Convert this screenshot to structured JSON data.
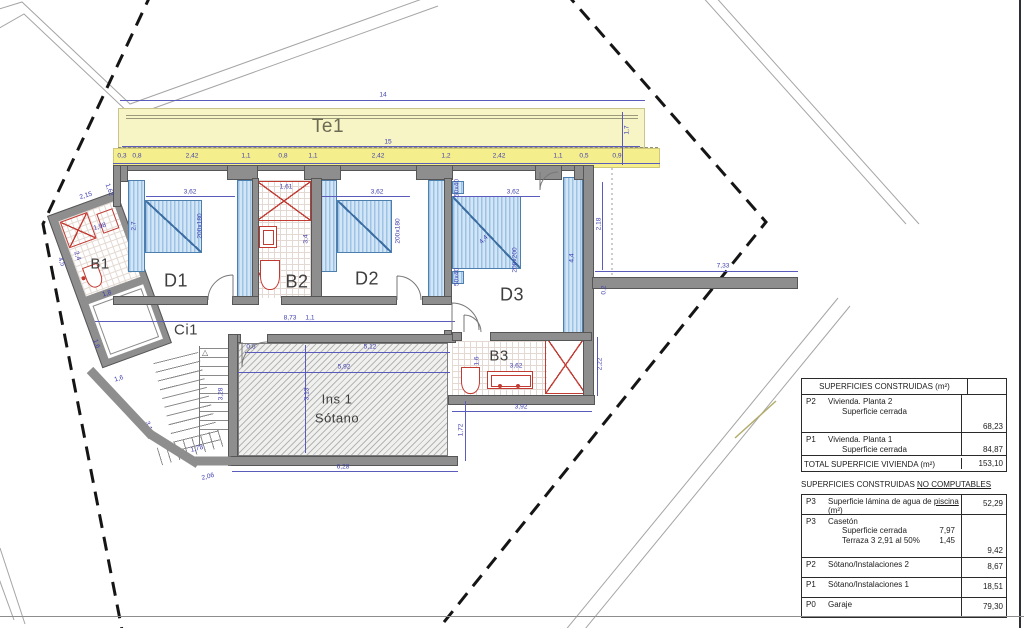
{
  "drawing": {
    "rooms": {
      "terrace": "Te1",
      "b1": "B1",
      "d1": "D1",
      "b2": "B2",
      "d2": "D2",
      "d3": "D3",
      "b3": "B3",
      "ci1": "Ci1",
      "ins_line1": "Ins 1",
      "ins_line2": "Sótano"
    },
    "stairs_arrow": "△",
    "colors": {
      "terrace_fill": "#f7f4c6",
      "terrace_band": "#f5ee8d",
      "wall_gray": "#8e8e8e",
      "furniture_blue": "#9cc3e6",
      "fixture_red": "#c23b33",
      "dimension_blue": "#3f3fb0"
    },
    "dimensions": [
      {
        "t": "14",
        "x": 383,
        "y": 95,
        "r": 0
      },
      {
        "t": "15",
        "x": 388,
        "y": 142,
        "r": 0
      },
      {
        "t": "1,7",
        "x": 627,
        "y": 130,
        "r": -90
      },
      {
        "t": "0,3",
        "x": 122,
        "y": 156,
        "r": 0
      },
      {
        "t": "0,8",
        "x": 137,
        "y": 156,
        "r": 0
      },
      {
        "t": "2,42",
        "x": 192,
        "y": 156,
        "r": 0
      },
      {
        "t": "1,1",
        "x": 246,
        "y": 156,
        "r": 0
      },
      {
        "t": "0,8",
        "x": 283,
        "y": 156,
        "r": 0
      },
      {
        "t": "1,1",
        "x": 313,
        "y": 156,
        "r": 0
      },
      {
        "t": "2,42",
        "x": 378,
        "y": 156,
        "r": 0
      },
      {
        "t": "1,2",
        "x": 446,
        "y": 156,
        "r": 0
      },
      {
        "t": "2,42",
        "x": 499,
        "y": 156,
        "r": 0
      },
      {
        "t": "1,1",
        "x": 558,
        "y": 156,
        "r": 0
      },
      {
        "t": "0,5",
        "x": 584,
        "y": 156,
        "r": 0
      },
      {
        "t": "0,9",
        "x": 617,
        "y": 156,
        "r": 0
      },
      {
        "t": "3,62",
        "x": 190,
        "y": 192,
        "r": 0
      },
      {
        "t": "2,7",
        "x": 134,
        "y": 226,
        "r": -90
      },
      {
        "t": "200x180",
        "x": 200,
        "y": 226,
        "r": -90
      },
      {
        "t": "1,61",
        "x": 286,
        "y": 187,
        "r": 0
      },
      {
        "t": "3,4",
        "x": 306,
        "y": 239,
        "r": -90
      },
      {
        "t": "3,62",
        "x": 377,
        "y": 192,
        "r": 0
      },
      {
        "t": "200x180",
        "x": 398,
        "y": 231,
        "r": -90
      },
      {
        "t": "3,62",
        "x": 513,
        "y": 192,
        "r": 0
      },
      {
        "t": "50x40",
        "x": 457,
        "y": 188,
        "r": -90
      },
      {
        "t": "50x40",
        "x": 457,
        "y": 277,
        "r": -90
      },
      {
        "t": "4,4",
        "x": 484,
        "y": 240,
        "r": -46
      },
      {
        "t": "200x200",
        "x": 515,
        "y": 260,
        "r": -90
      },
      {
        "t": "4,4",
        "x": 572,
        "y": 258,
        "r": -90
      },
      {
        "t": "2,18",
        "x": 599,
        "y": 224,
        "r": -90
      },
      {
        "t": "0,2",
        "x": 604,
        "y": 290,
        "r": -90
      },
      {
        "t": "7,33",
        "x": 723,
        "y": 266,
        "r": 0
      },
      {
        "t": "8,73",
        "x": 290,
        "y": 318,
        "r": 0
      },
      {
        "t": "1,1",
        "x": 310,
        "y": 318,
        "r": 0
      },
      {
        "t": "2,15",
        "x": 86,
        "y": 196,
        "r": -17
      },
      {
        "t": "1,62",
        "x": 109,
        "y": 190,
        "r": 70
      },
      {
        "t": "1,98",
        "x": 100,
        "y": 227,
        "r": -17
      },
      {
        "t": "2,4",
        "x": 77,
        "y": 256,
        "r": 70
      },
      {
        "t": "1,8",
        "x": 107,
        "y": 294,
        "r": -17
      },
      {
        "t": "4,5",
        "x": 61,
        "y": 262,
        "r": 70
      },
      {
        "t": "1,6",
        "x": 96,
        "y": 344,
        "r": 70
      },
      {
        "t": "1,6",
        "x": 119,
        "y": 379,
        "r": -17
      },
      {
        "t": "3,1",
        "x": 148,
        "y": 426,
        "r": 70
      },
      {
        "t": "3,28",
        "x": 221,
        "y": 394,
        "r": -90
      },
      {
        "t": "1,78",
        "x": 197,
        "y": 449,
        "r": -14
      },
      {
        "t": "2,06",
        "x": 208,
        "y": 477,
        "r": -14
      },
      {
        "t": "0,6",
        "x": 251,
        "y": 347,
        "r": 0
      },
      {
        "t": "5,12",
        "x": 370,
        "y": 347,
        "r": 0
      },
      {
        "t": "5,92",
        "x": 344,
        "y": 367,
        "r": 0
      },
      {
        "t": "3,13",
        "x": 307,
        "y": 394,
        "r": -90
      },
      {
        "t": "6,28",
        "x": 343,
        "y": 467,
        "r": 0
      },
      {
        "t": "1,72",
        "x": 461,
        "y": 430,
        "r": -90
      },
      {
        "t": "1,6",
        "x": 477,
        "y": 361,
        "r": -90
      },
      {
        "t": "3,62",
        "x": 516,
        "y": 366,
        "r": 0
      },
      {
        "t": "3,92",
        "x": 521,
        "y": 407,
        "r": 0
      },
      {
        "t": "2,22",
        "x": 600,
        "y": 364,
        "r": -90
      }
    ]
  },
  "panel": {
    "constructed": {
      "header": "SUPERFICIES CONSTRUIDAS (m²)",
      "p2_code": "P2",
      "p2_line1": "Vivienda. Planta 2",
      "p2_line2": "Superficie cerrada",
      "p2_value": "68,23",
      "p1_code": "P1",
      "p1_line1": "Vivienda. Planta 1",
      "p1_line2": "Superficie cerrada",
      "p1_value": "84,87",
      "total_label": "TOTAL SUPERFICIE VIVIENDA  (m²)",
      "total_value": "153,10"
    },
    "subheader_plain": "SUPERFICIES CONSTRUIDAS ",
    "subheader_underlined": "NO COMPUTABLES",
    "non_computable_rows": [
      {
        "code": "P3",
        "desc_before": "Superficie lámina de agua de ",
        "desc_u": "piscina",
        "desc_after": " (m²)",
        "value": "52,29",
        "h": 19
      },
      {
        "code": "P3",
        "desc": "Casetón",
        "subs": [
          [
            "Superficie cerrada",
            "7,97"
          ],
          [
            "Terraza 3    2,91 al 50%",
            "1,45"
          ]
        ],
        "value": "9,42",
        "h": 42
      },
      {
        "code": "P2",
        "desc": "Sótano/Instalaciones 2",
        "value": "8,67",
        "h": 19
      },
      {
        "code": "P1",
        "desc": "Sótano/Instalaciones 1",
        "value": "18,51",
        "h": 19
      },
      {
        "code": "P0",
        "desc": "Garaje",
        "value": "79,30",
        "h": 19
      }
    ]
  }
}
